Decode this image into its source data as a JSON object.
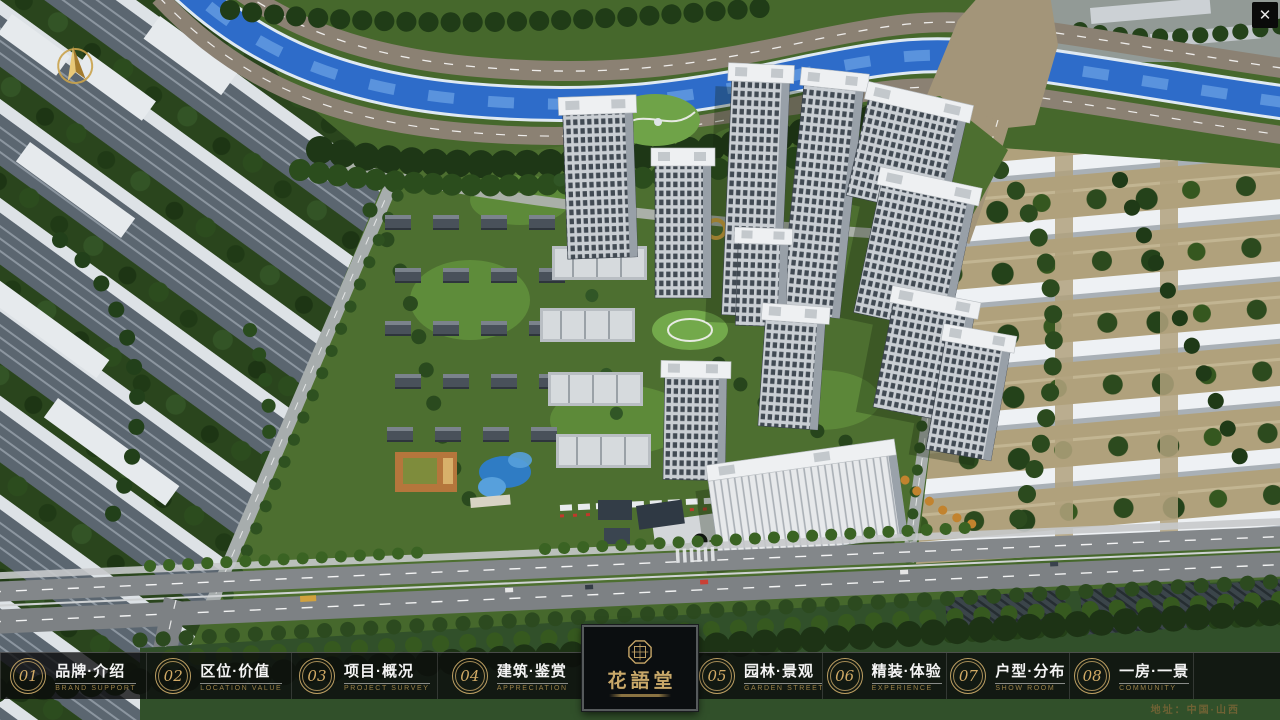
{
  "window": {
    "close_icon": "✕"
  },
  "map_overlay": {
    "compass_icon": "north-arrow"
  },
  "nav": {
    "items": [
      {
        "num": "01",
        "title": "品牌·介绍",
        "subtitle": "BRAND SUPPORT"
      },
      {
        "num": "02",
        "title": "区位·价值",
        "subtitle": "LOCATION VALUE"
      },
      {
        "num": "03",
        "title": "项目·概况",
        "subtitle": "PROJECT SURVEY"
      },
      {
        "num": "04",
        "title": "建筑·鉴赏",
        "subtitle": "APPRECIATION"
      },
      {
        "num": "05",
        "title": "园林·景观",
        "subtitle": "GARDEN STREET"
      },
      {
        "num": "06",
        "title": "精装·体验",
        "subtitle": "EXPERIENCE"
      },
      {
        "num": "07",
        "title": "户型·分布",
        "subtitle": "SHOW ROOM"
      },
      {
        "num": "08",
        "title": "一房·一景",
        "subtitle": "COMMUNITY"
      }
    ]
  },
  "logo": {
    "title": "花語堂",
    "seal_icon": "octagon-seal"
  },
  "footer": {
    "address": "地址：中国·山西"
  },
  "colors": {
    "gold_accent": "#c9a869",
    "subtitle_gold": "#9b8148",
    "bar_background": "rgba(10,10,12,0.78)",
    "river_blue": "#2e6cc9",
    "grass_green": "#4d6f30",
    "road_gray": "#83878a",
    "building_white": "#eef0f3",
    "address_text": "#6f6234"
  }
}
